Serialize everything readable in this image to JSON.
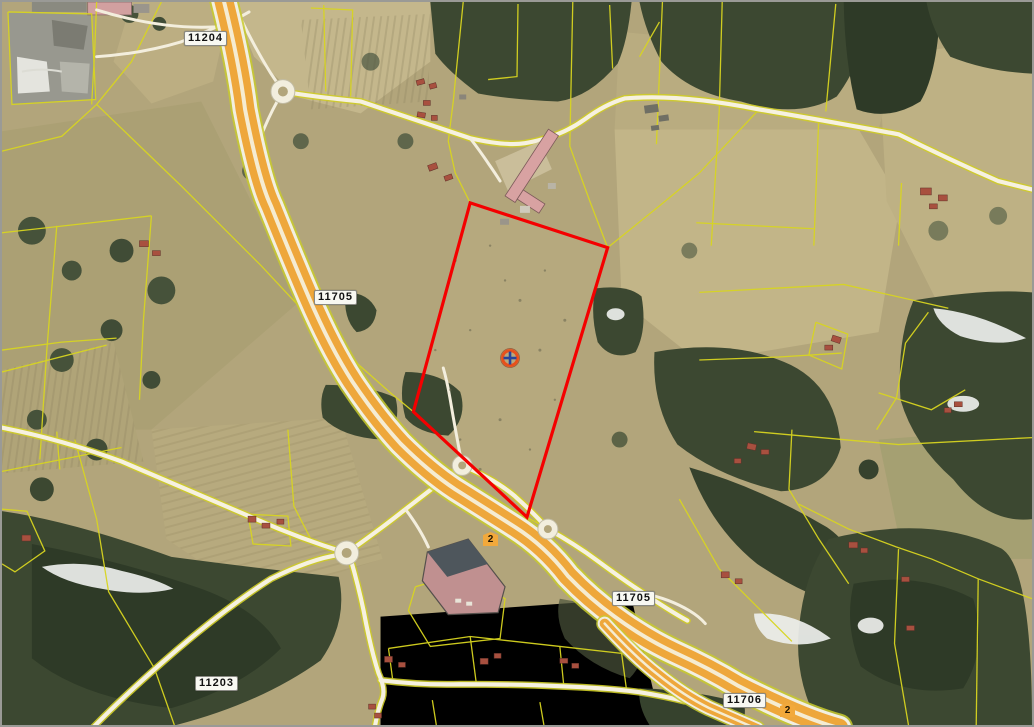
{
  "map": {
    "title": "Aerial cadastral map with selected parcel",
    "road_labels": [
      {
        "id": "road-11204",
        "text": "11204"
      },
      {
        "id": "road-11705-north",
        "text": "11705"
      },
      {
        "id": "road-11203",
        "text": "11203"
      },
      {
        "id": "road-11705-south",
        "text": "11705"
      },
      {
        "id": "road-11706",
        "text": "11706"
      }
    ],
    "route_shields": [
      {
        "id": "national-road-2-a",
        "text": "2"
      },
      {
        "id": "national-road-2-b",
        "text": "2"
      }
    ],
    "selected_parcel": {
      "outline_color": "#f40000",
      "marker": "crosshair-circle-marker"
    },
    "colors": {
      "field_tan": "#b2a57b",
      "forest_green": "#3c4831",
      "cadastral_line_yellow": "#d8d520",
      "highway_orange": "#eea73b",
      "minor_road_white": "#f6f1e0",
      "selection_red": "#f40000",
      "marker_ring_orange": "#e8501b",
      "marker_cross_blue": "#27449c"
    }
  }
}
